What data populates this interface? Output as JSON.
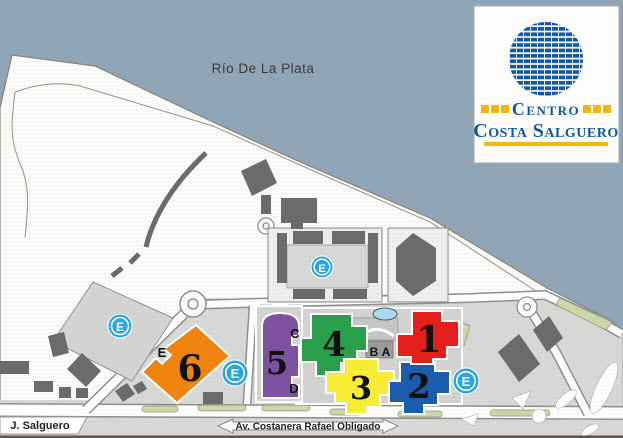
{
  "logo": {
    "line1": "Centro",
    "line2": "Costa Salguero"
  },
  "labels": {
    "river": "Río De La Plata",
    "street_left": "J. Salguero",
    "street_bottom": "Av. Costanera Rafael Obligado"
  },
  "pavilions": [
    {
      "number": "1",
      "color": "#e41f1c"
    },
    {
      "number": "2",
      "color": "#1a5dad"
    },
    {
      "number": "3",
      "color": "#f8ee35"
    },
    {
      "number": "4",
      "color": "#2aa04c"
    },
    {
      "number": "5",
      "color": "#7c52a1"
    },
    {
      "number": "6",
      "color": "#ef840f"
    }
  ],
  "entrances": {
    "a": "A",
    "b": "B",
    "c": "C",
    "d": "D",
    "e": "E"
  },
  "parking_symbol": "E",
  "colors": {
    "water": "#90a5b6",
    "land": "#fbfbfa",
    "complex_zone": "#d8d8d6",
    "building": "#6b6b6b",
    "road": "#ffffff",
    "green_strip": "#cbd8a8",
    "parking_badge": "#2aa4e4",
    "pond": "#a9daf3",
    "logo_blue": "#11569f",
    "logo_yellow": "#f2b80d"
  }
}
